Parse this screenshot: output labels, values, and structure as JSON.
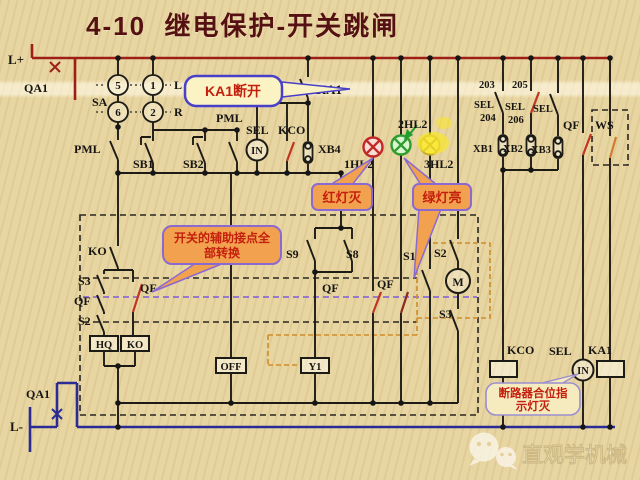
{
  "title": "4-10  继电保护-开关跳闸",
  "watermark": "直观学机械",
  "callouts": {
    "ka1_open": "KA1断开",
    "red_lamp_off": "红灯灭",
    "green_lamp_on": "绿灯亮",
    "aux_line1": "开关的辅助接点全",
    "aux_line2": "部转换",
    "breaker_line1": "断路器合位指",
    "breaker_line2": "示灯灭"
  },
  "labels": {
    "l_plus": "L+",
    "qa1_top": "QA1",
    "sa": "SA",
    "sw5": "5",
    "sw1": "1",
    "sw6": "6",
    "sw2": "2",
    "dir_l": "L",
    "dir_r": "R",
    "pml_top": "PML",
    "pml_left": "PML",
    "sb1": "SB1",
    "sb2": "SB2",
    "sel_top": "SEL",
    "kco_top": "KCO",
    "in_top": "IN",
    "xb4": "XB4",
    "ka1_contact": "KA1",
    "hl2_1": "1HL2",
    "hl2_2": "2HL2",
    "hl2_3": "3HL2",
    "n203": "203",
    "n205": "205",
    "n204": "204",
    "n206": "206",
    "sel_a": "SEL",
    "sel_b": "SEL",
    "sel_c": "SEL",
    "xb1": "XB1",
    "xb2": "XB2",
    "xb3": "XB3",
    "qf_top": "QF",
    "ws": "WS",
    "ko_contact": "KO",
    "s3_left": "S3",
    "qf_left": "QF",
    "s2_left": "S2",
    "qf_mid": "QF",
    "hq_box": "HQ",
    "ko_box": "KO",
    "off_box": "OFF",
    "y1_box": "Y1",
    "s9": "S9",
    "s8": "S8",
    "qf_a": "QF",
    "qf_b": "QF",
    "s1": "S1",
    "s2_right": "S2",
    "m_motor": "M",
    "s3_right": "S3",
    "kco_bot": "KCO",
    "sel_bot": "SEL",
    "ka1_bot": "KA1",
    "in_bot": "IN",
    "qa1_bot": "QA1",
    "l_minus": "L-"
  },
  "colors": {
    "background": "#e8d6a2",
    "positive_bus_red": "#9e1f17",
    "negative_bus_blue": "#2b2b96",
    "wire_black": "#1d1b16",
    "transition_blade_red": "#c03524",
    "linkage_purple_dashed": "#8d6cd0",
    "linkage_orange_dashed": "#cf8c28",
    "callout_orange_fill": "#f2a24e",
    "callout_yellow_fill": "#fbf3c4",
    "callout_border_purple": "#8a6ad0",
    "callout_border_blue": "#4840c8",
    "callout_text_red": "#c41f0e",
    "lamp_red": "#c22828",
    "lamp_green": "#2f9e2f",
    "lamp_yellow": "#e8d12c",
    "title_maroon": "#551111"
  }
}
